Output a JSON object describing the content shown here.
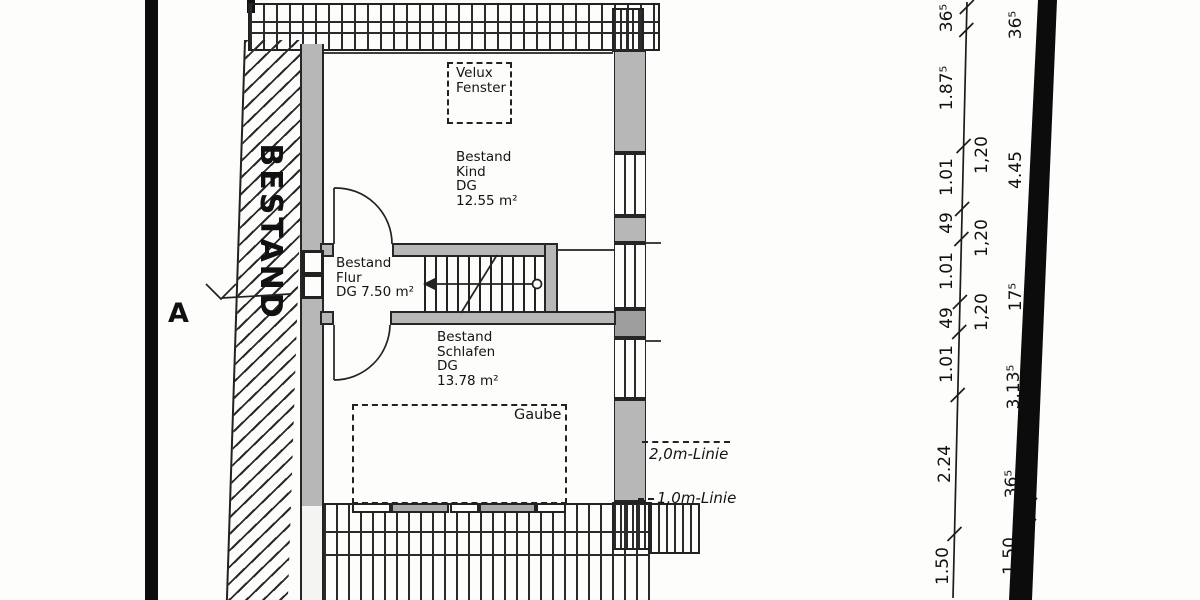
{
  "plan": {
    "existing_wall_label": "BESTAND",
    "section_marker": "A",
    "rooms": {
      "kind": {
        "lines": [
          "Bestand",
          "Kind",
          "DG",
          "12.55 m²"
        ]
      },
      "flur": {
        "lines": [
          "Bestand",
          "Flur",
          "DG 7.50 m²"
        ]
      },
      "schlafen": {
        "lines": [
          "Bestand",
          "Schlafen",
          "DG",
          "13.78 m²"
        ]
      }
    },
    "annotations": {
      "velux": {
        "lines": [
          "Velux",
          "Fenster"
        ]
      },
      "gaube": "Gaube",
      "line_2m": "2,0m-Linie",
      "line_1m": "1,0m-Linie"
    }
  },
  "dimensions": {
    "chain_inner": [
      "36⁵",
      "1.87⁵",
      "1.01",
      "49",
      "1.01",
      "49",
      "1.01",
      "2.24",
      "1.50"
    ],
    "chain_middle": [
      "1,20",
      "1,20",
      "1,20"
    ],
    "chain_outer": [
      "36⁵",
      "4.45",
      "17⁵",
      "3.13⁵",
      "36⁵",
      "1.50"
    ]
  },
  "colors": {
    "paper": "#fdfdfc",
    "ink": "#1a1a1a",
    "wall_fill": "#b7b7b7",
    "scan_band": "#0d0d0d"
  }
}
